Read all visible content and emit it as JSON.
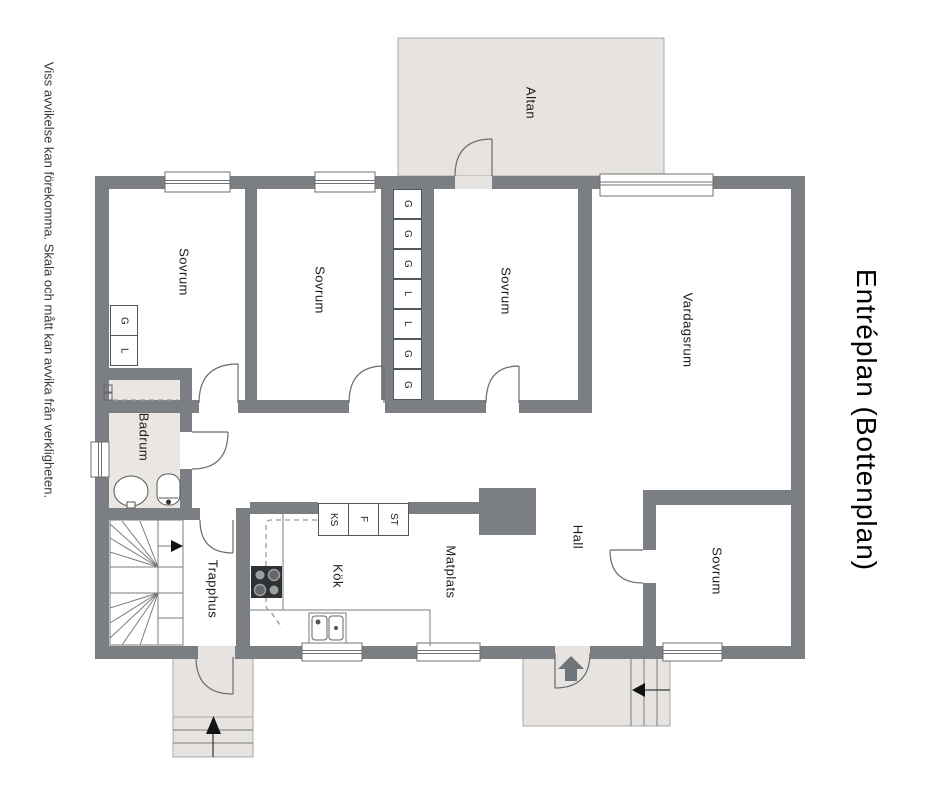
{
  "title": "Entréplan (Bottenplan)",
  "disclaimer": "Viss avvikelse kan förekomma. Skala och mått kan avvika från verkligheten.",
  "rooms": {
    "altan": "Altan",
    "sovrum_1": "Sovrum",
    "sovrum_2": "Sovrum",
    "sovrum_3": "Sovrum",
    "vardagsrum": "Vardagsrum",
    "sovrum_4": "Sovrum",
    "hall": "Hall",
    "matplats": "Matplats",
    "kok": "Kök",
    "trapphus": "Trapphus",
    "badrum": "Badrum"
  },
  "closet_column": {
    "cells": [
      "G",
      "G",
      "G",
      "L",
      "L",
      "G",
      "G"
    ]
  },
  "bedroom_closet": {
    "cells": [
      "G",
      "L"
    ]
  },
  "kitchen_units": {
    "cells": [
      "KS",
      "F",
      "ST"
    ]
  },
  "colors": {
    "wall": "#7b7e82",
    "floor_light": "#e6e3e0",
    "line": "#6a6c6e"
  }
}
